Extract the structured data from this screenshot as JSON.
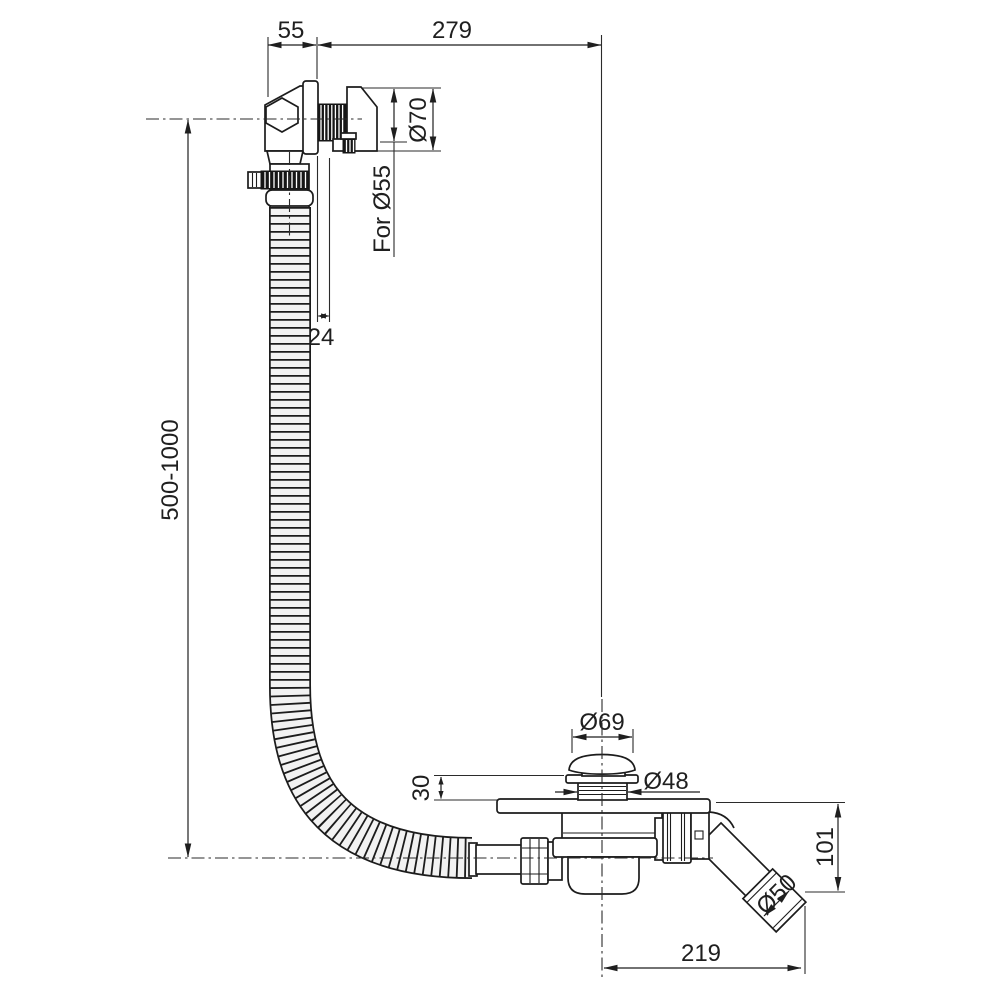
{
  "colors": {
    "line": "#1f1f1f",
    "dark_fill": "#161616",
    "background": "#ffffff"
  },
  "dimensions": {
    "overflow_offset": "55",
    "span_to_drain": "279",
    "overflow_flange_dia": "Ø70",
    "overflow_hole": "For Ø55",
    "overflow_depth": "24",
    "hose_length_range": "500-1000",
    "plug_cap_dia": "Ø69",
    "drain_thread_dia": "Ø48",
    "drain_height": "30",
    "outlet_drop": "101",
    "outlet_dia": "Ø50",
    "outlet_reach": "219"
  }
}
